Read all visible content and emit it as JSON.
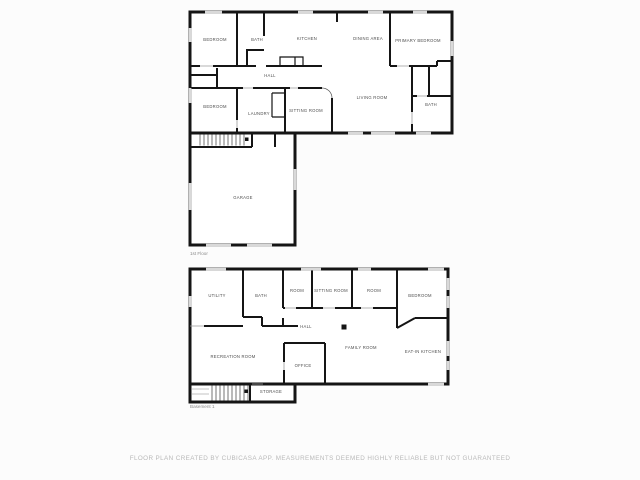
{
  "floors": [
    {
      "title": "1st Floor",
      "rooms": [
        {
          "label": "BEDROOM"
        },
        {
          "label": "BATH"
        },
        {
          "label": "KITCHEN"
        },
        {
          "label": "DINING AREA"
        },
        {
          "label": "PRIMARY BEDROOM"
        },
        {
          "label": "HALL"
        },
        {
          "label": "BEDROOM"
        },
        {
          "label": "LAUNDRY"
        },
        {
          "label": "SITTING ROOM"
        },
        {
          "label": "LIVING ROOM"
        },
        {
          "label": "BATH"
        },
        {
          "label": "GARAGE"
        }
      ]
    },
    {
      "title": "Basement 1",
      "rooms": [
        {
          "label": "UTILITY"
        },
        {
          "label": "BATH"
        },
        {
          "label": "ROOM"
        },
        {
          "label": "SITTING ROOM"
        },
        {
          "label": "ROOM"
        },
        {
          "label": "BEDROOM"
        },
        {
          "label": "HALL"
        },
        {
          "label": "RECREATION ROOM"
        },
        {
          "label": "OFFICE"
        },
        {
          "label": "FAMILY ROOM"
        },
        {
          "label": "EAT-IN KITCHEN"
        },
        {
          "label": "STORAGE"
        }
      ]
    }
  ],
  "footer": {
    "disclaimer": "FLOOR PLAN CREATED BY CUBICASA APP. MEASUREMENTS DEEMED HIGHLY RELIABLE BUT NOT GUARANTEED"
  },
  "colors": {
    "background": "#fcfcfc",
    "wall": "#151515",
    "window": "#d9d9d9",
    "room_label": "#4d4d4d",
    "floor_title": "#8a8a8a",
    "disclaimer": "#b9b9b9"
  }
}
